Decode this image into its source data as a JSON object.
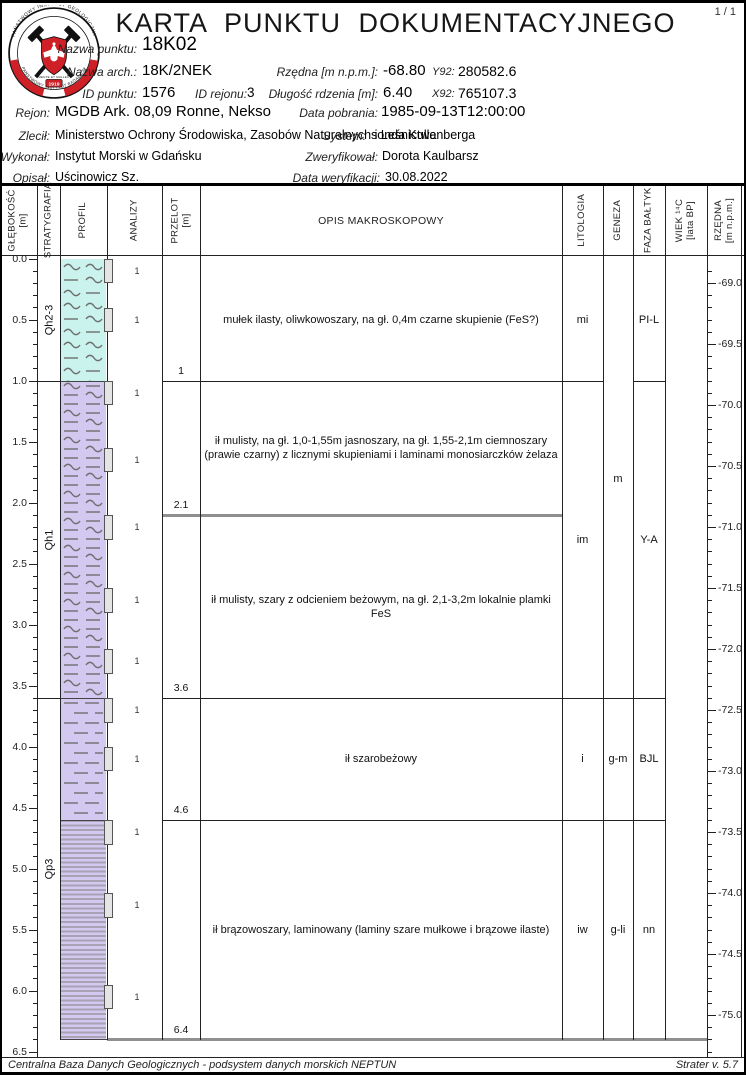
{
  "page": {
    "number": "1 / 1",
    "footer_left": "Centralna Baza Danych Geologicznych - podsystem danych morskich NEPTUN",
    "footer_right": "Strater v. 5.7"
  },
  "header": {
    "title": "KARTA PUNKTU DOKUMENTACYJNEGO",
    "logo": {
      "ring_top": "PAŃSTWOWY INSTYTUT GEOLOGICZNY",
      "ring_bottom": "PAŃSTWOWY INSTYTUT BADAWCZY",
      "motto": "MENTE ET MALLEO",
      "year": "1919"
    },
    "fields": {
      "nazwa_punktu": {
        "label": "Nazwa punktu:",
        "value": "18K02"
      },
      "nazwa_arch": {
        "label": "Nazwa arch.:",
        "value": "18K/2NEK"
      },
      "rzedna": {
        "label": "Rzędna [m n.p.m.]:",
        "value": "-68.80"
      },
      "y92": {
        "label": "Y92:",
        "value": "280582.6"
      },
      "id_punktu": {
        "label": "ID punktu:",
        "value": "1576"
      },
      "id_rejonu": {
        "label": "ID rejonu:",
        "value": "3"
      },
      "dlugosc_rdzenia": {
        "label": "Długość rdzenia [m]:",
        "value": "6.40"
      },
      "x92": {
        "label": "X92:",
        "value": "765107.3"
      },
      "rejon": {
        "label": "Rejon:",
        "value": "MGDB Ark. 08,09 Ronne, Nekso"
      },
      "data_pobrania": {
        "label": "Data pobrania:",
        "value": "1985-09-13T12:00:00"
      },
      "zlecil": {
        "label": "Zlecił:",
        "value": "Ministerstwo Ochrony Środowiska, Zasobów Naturalnych i Leśnictwa"
      },
      "system": {
        "label": "System:",
        "value": "sonda Kullenberga"
      },
      "wykonal": {
        "label": "Wykonał:",
        "value": "Instytut Morski w Gdańsku"
      },
      "zweryfikowal": {
        "label": "Zweryfikował:",
        "value": "Dorota Kaulbarsz"
      },
      "opisal": {
        "label": "Opisał:",
        "value": "Uścinowicz Sz."
      },
      "data_weryfikacji": {
        "label": "Data weryfikacji:",
        "value": "30.08.2022"
      }
    }
  },
  "log": {
    "columns": [
      {
        "label": "GŁĘBOKOŚĆ",
        "sub": "[m]"
      },
      {
        "label": "STRATYGRAFIA"
      },
      {
        "label": "PROFIL"
      },
      {
        "label": "ANALIZY"
      },
      {
        "label": "PRZELOT",
        "sub": "[m]"
      },
      {
        "label": "OPIS MAKROSKOPOWY"
      },
      {
        "label": "LITOLOGIA"
      },
      {
        "label": "GENEZA"
      },
      {
        "label": "FAZA BAŁTYK"
      },
      {
        "label": "WIEK ¹⁴C",
        "sub": "[lata BP]"
      },
      {
        "label": "RZĘDNA",
        "sub": "[m n.p.m.]"
      }
    ],
    "depth_axis": {
      "min": 0,
      "max": 6.5,
      "minor_step": 0.1,
      "major_step": 0.5,
      "major_labels": [
        "0.0",
        "0.5",
        "1.0",
        "1.5",
        "2.0",
        "2.5",
        "3.0",
        "3.5",
        "4.0",
        "4.5",
        "5.0",
        "5.5",
        "6.0",
        "6.5"
      ]
    },
    "elevation_axis": {
      "surface": -68.8,
      "minor_step": 0.1,
      "major_step": 0.5,
      "major_labels": [
        "-69.0",
        "-69.5",
        "-70.0",
        "-70.5",
        "-71.0",
        "-71.5",
        "-72.0",
        "-72.5",
        "-73.0",
        "-73.5",
        "-74.0",
        "-74.5",
        "-75.0"
      ]
    },
    "stratigraphy": [
      {
        "label": "Qh2-3",
        "top": 0.0,
        "bottom": 1.0
      },
      {
        "label": "Qh1",
        "top": 1.0,
        "bottom": 3.6
      },
      {
        "label": "Qp3",
        "top": 3.6,
        "bottom": 6.4
      }
    ],
    "profile": [
      {
        "pattern": "mud-silt",
        "top": 0.0,
        "bottom": 1.0
      },
      {
        "pattern": "silt-clay",
        "top": 1.0,
        "bottom": 3.6
      },
      {
        "pattern": "clay",
        "top": 3.6,
        "bottom": 4.6
      },
      {
        "pattern": "varved-clay",
        "top": 4.6,
        "bottom": 6.4
      }
    ],
    "samples": [
      {
        "depth": 0.0,
        "count": "1"
      },
      {
        "depth": 0.4,
        "count": "1"
      },
      {
        "depth": 1.0,
        "count": "1"
      },
      {
        "depth": 1.55,
        "count": "1"
      },
      {
        "depth": 2.1,
        "count": "1"
      },
      {
        "depth": 2.7,
        "count": "1"
      },
      {
        "depth": 3.2,
        "count": "1"
      },
      {
        "depth": 3.6,
        "count": "1"
      },
      {
        "depth": 4.0,
        "count": "1"
      },
      {
        "depth": 4.6,
        "count": "1"
      },
      {
        "depth": 5.2,
        "count": "1"
      },
      {
        "depth": 5.95,
        "count": "1"
      }
    ],
    "intervals": [
      {
        "top": 0.0,
        "bottom": 1.0,
        "przelot_label": "1",
        "boundary": "thin",
        "opis_lines": [
          "mułek ilasty, oliwkowoszary, na gł. 0,4m czarne skupienie (FeS?)"
        ]
      },
      {
        "top": 1.0,
        "bottom": 2.1,
        "przelot_label": "2.1",
        "boundary": "thick",
        "opis_lines": [
          "ił mulisty, na gł. 1,0-1,55m jasnoszary, na gł. 1,55-2,1m ciemnoszary",
          "(prawie czarny) z licznymi skupieniami i laminami monosiarczków żelaza"
        ]
      },
      {
        "top": 2.1,
        "bottom": 3.6,
        "przelot_label": "3.6",
        "boundary": "thin",
        "opis_lines": [
          "ił mulisty, szary z odcieniem beżowym, na gł. 2,1-3,2m  lokalnie  plamki",
          "FeS"
        ]
      },
      {
        "top": 3.6,
        "bottom": 4.6,
        "przelot_label": "4.6",
        "boundary": "thin",
        "opis_lines": [
          "ił szarobeżowy"
        ]
      },
      {
        "top": 4.6,
        "bottom": 6.4,
        "przelot_label": "6.4",
        "boundary": "thick",
        "opis_lines": [
          "ił brązowoszary, laminowany (laminy szare mułkowe i brązowe ilaste)"
        ]
      }
    ],
    "litologia": [
      {
        "label": "mi",
        "top": 0.0,
        "bottom": 1.0
      },
      {
        "label": "im",
        "top": 1.0,
        "bottom": 3.6
      },
      {
        "label": "i",
        "top": 3.6,
        "bottom": 4.6
      },
      {
        "label": "iw",
        "top": 4.6,
        "bottom": 6.4
      }
    ],
    "geneza": [
      {
        "label": "m",
        "top": 0.0,
        "bottom": 3.6
      },
      {
        "label": "g-m",
        "top": 3.6,
        "bottom": 4.6
      },
      {
        "label": "g-li",
        "top": 4.6,
        "bottom": 6.4
      }
    ],
    "faza_baltyk": [
      {
        "label": "PI-L",
        "top": 0.0,
        "bottom": 1.0
      },
      {
        "label": "Y-A",
        "top": 1.0,
        "bottom": 3.6
      },
      {
        "label": "BJL",
        "top": 3.6,
        "bottom": 4.6
      },
      {
        "label": "nn",
        "top": 4.6,
        "bottom": 6.4
      }
    ],
    "wiek_14c": []
  },
  "colors": {
    "red": "#cf2027",
    "mud_fill": "#c9f3ec",
    "clay_fill": "#d2c8f0",
    "varve_line": "#a8a2b4",
    "pattern_stroke": "#6e6e6e",
    "sample_fill": "#e4e4e4",
    "thick_line": "#8f8f8f",
    "line_dark": "#222222"
  }
}
